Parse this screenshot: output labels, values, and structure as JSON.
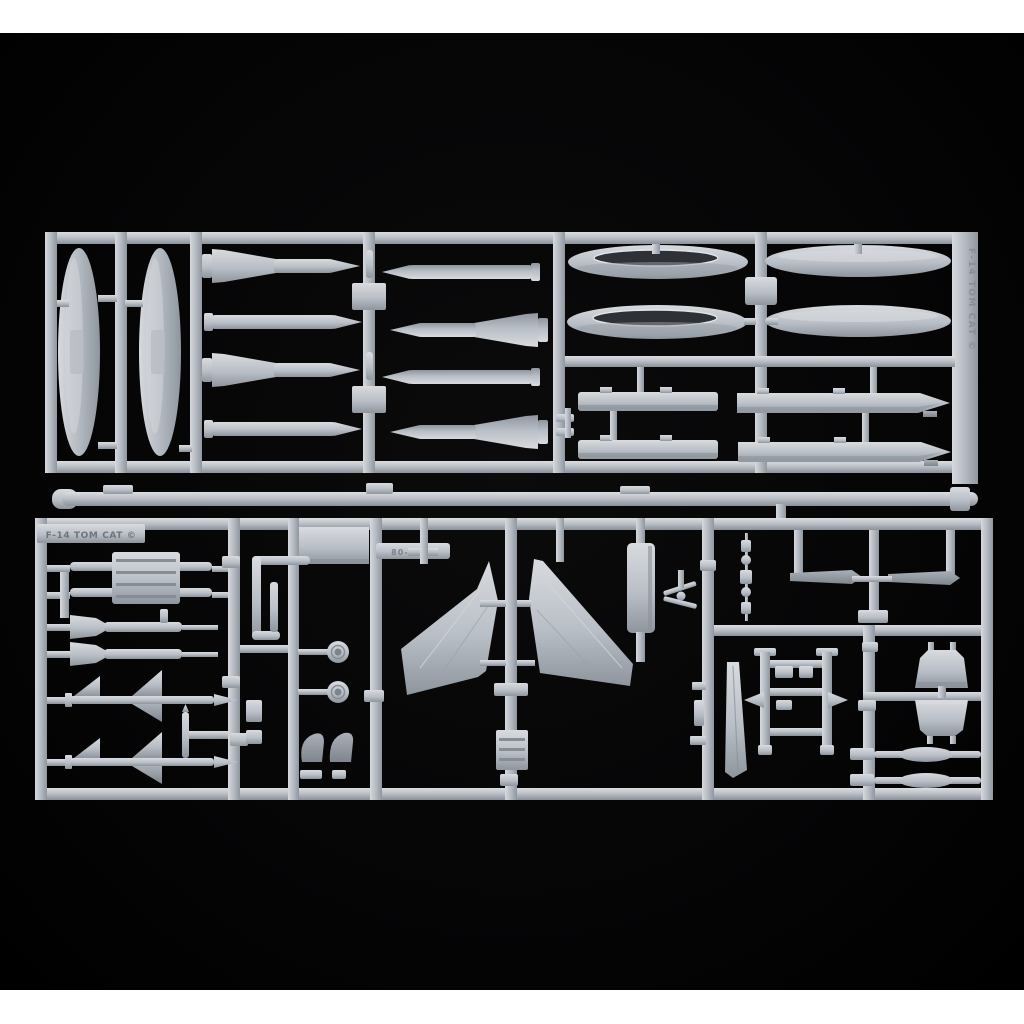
{
  "scene": {
    "type": "product photograph",
    "subject": "Two injection-molded light-grey styrene model-kit sprue frames photographed on a black background, white letterbox bands at top and bottom",
    "kit_name": "F-14 TOM CAT plastic model kit sprues"
  },
  "colors": {
    "letterbox": "#ffffff",
    "backdrop": "#050506",
    "plastic_highlight": "#dadde1",
    "plastic": "#c3c8ce",
    "plastic_mid": "#aab0b7",
    "plastic_shadow": "#8a9199",
    "part_dark": "#969da5",
    "slot_interior": "#2e3135"
  },
  "labels": {
    "bottom_sprue_emboss": "F-14 TOM CAT ©",
    "top_sprue_emboss_vertical": "F-14 TOM CAT ©",
    "mold_code_emboss": "80-1192"
  },
  "sprues": {
    "top": {
      "name": "weapons-and-tanks-sprue",
      "parts": [
        "vertical drop-tank half x2",
        "finned missile half x4",
        "plain missile half x4",
        "large fuel-tank half with slot opening x2",
        "large fuel-tank half plain x2",
        "wing pylon flat x2",
        "wing pylon pointed x2",
        "sway-brace small parts"
      ]
    },
    "middle": {
      "name": "loose-runner-bar",
      "parts": [
        "long runner rod with tabs"
      ]
    },
    "bottom": {
      "name": "airframe-details-sprue",
      "parts": [
        "embossed name plate",
        "launcher rails with ribbed block",
        "spade-tail missile x2",
        "sidewinder missile with delta fins x2",
        "small vertical rod",
        "rectangular panel",
        "elbow pipes",
        "main wheel x2",
        "dark intake lip x2",
        "mold-code plate",
        "outer wing panel left",
        "outer wing panel right",
        "ribbed box part",
        "tall fin panel",
        "small propeller part",
        "chain of small links",
        "dark aileron blade x2",
        "H-frame seat rails",
        "ventral fin",
        "windscreen frame",
        "canopy frame",
        "thin rail with fairing x2"
      ]
    }
  }
}
